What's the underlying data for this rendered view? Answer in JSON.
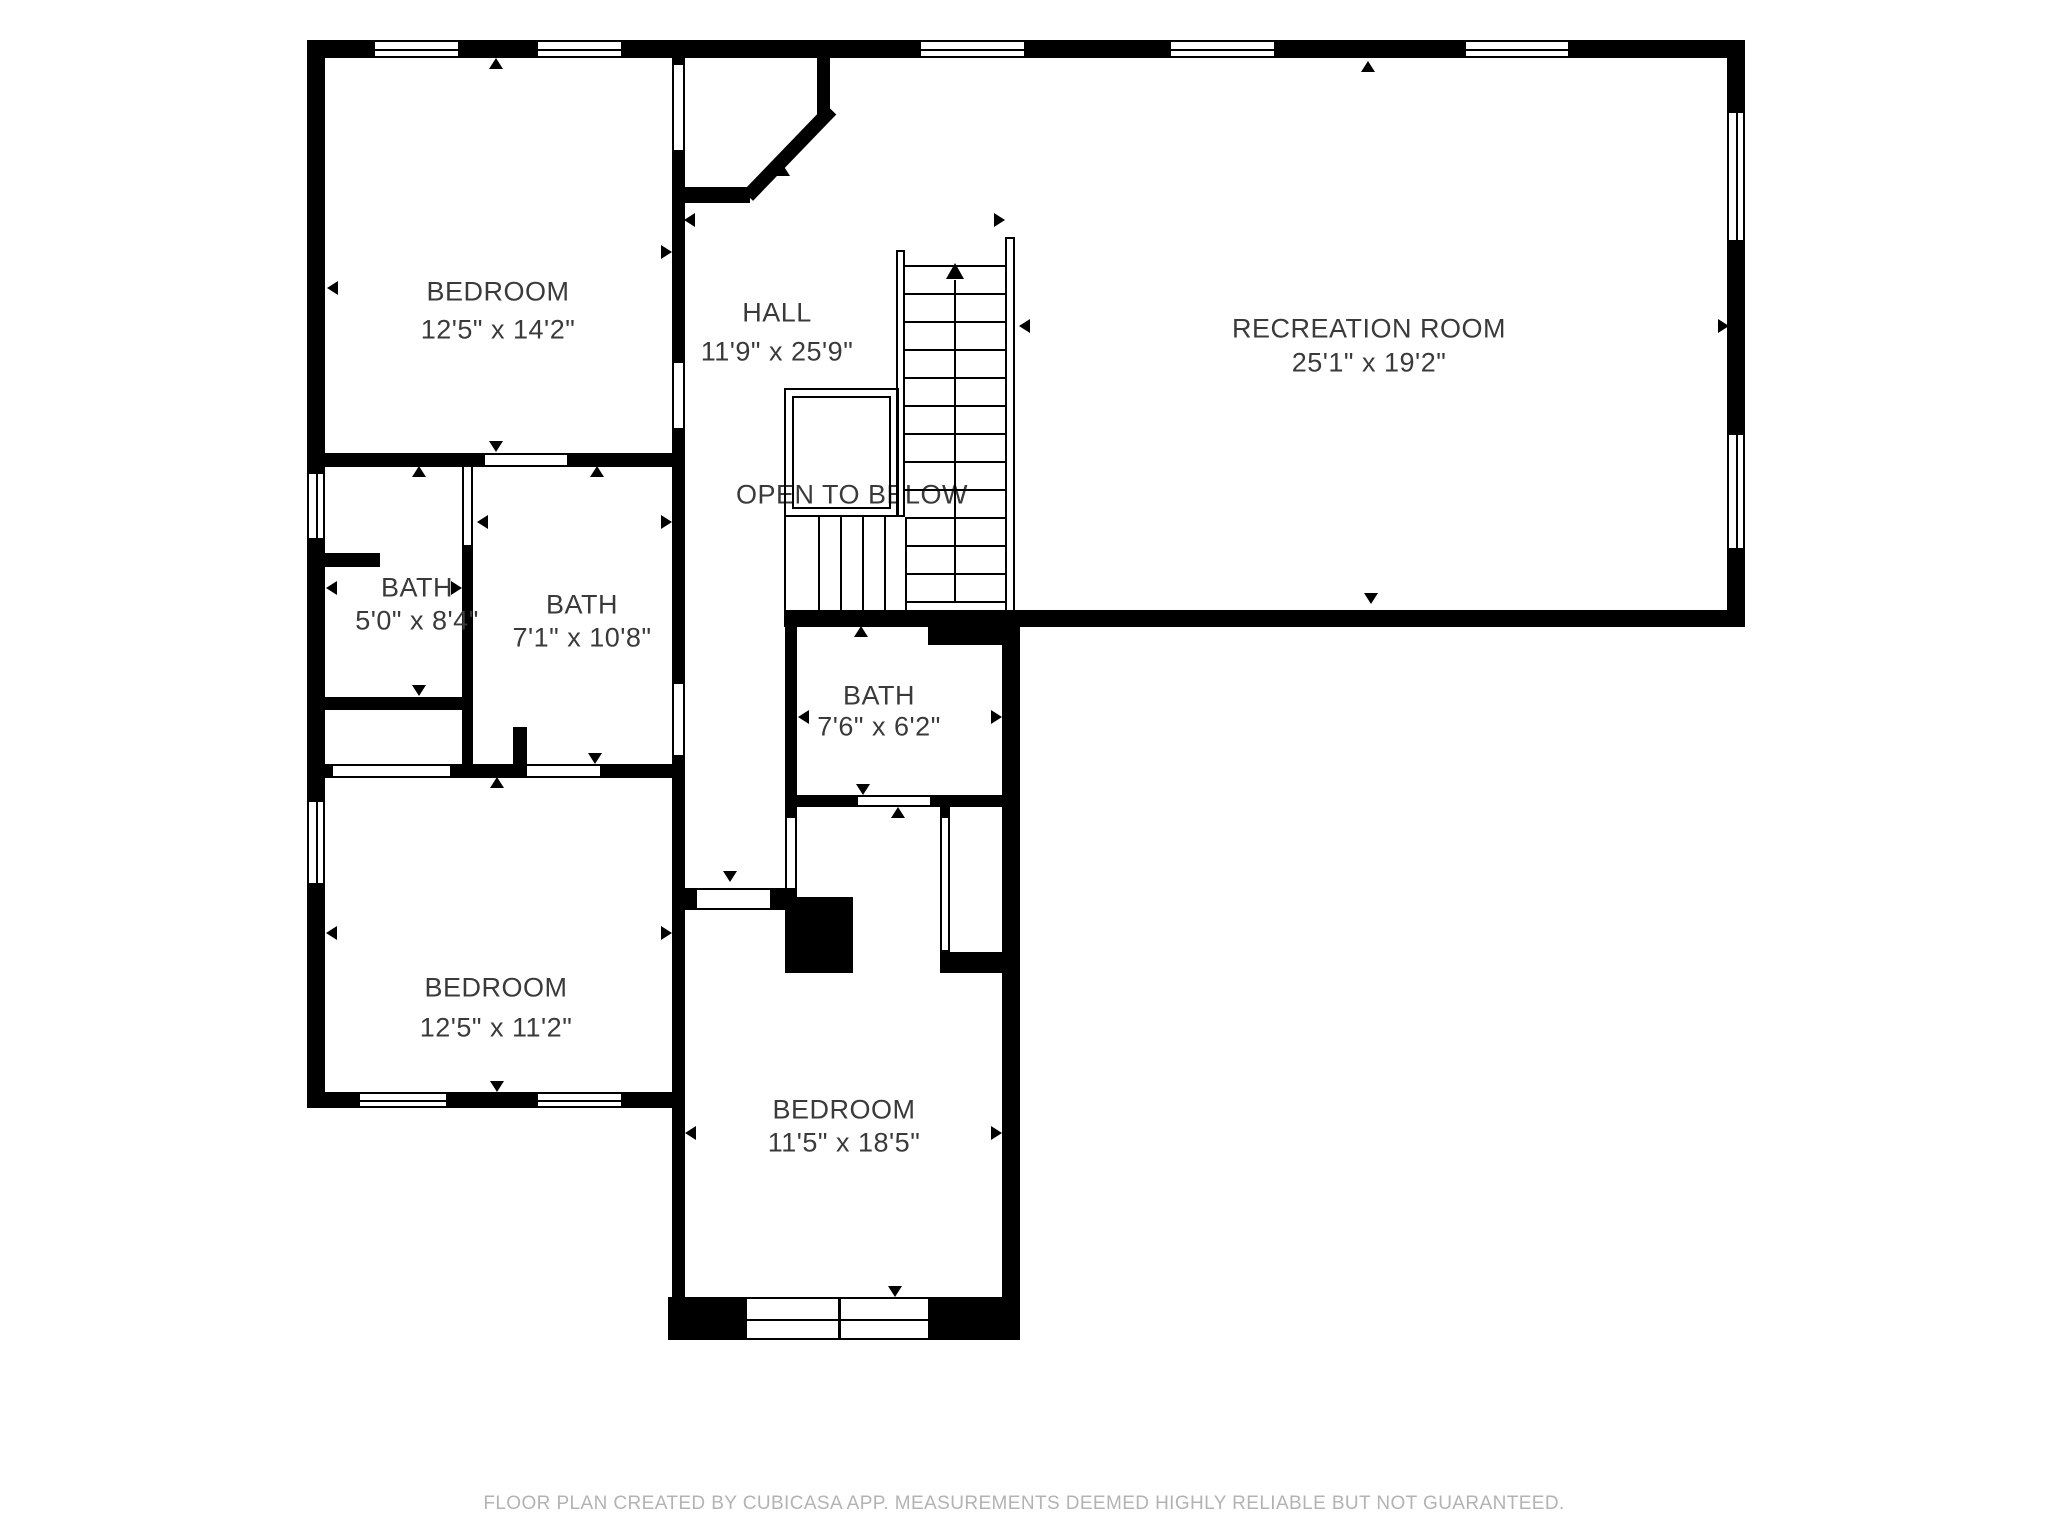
{
  "canvas": {
    "width": 2048,
    "height": 1536,
    "background": "#ffffff",
    "wall_color": "#000000",
    "label_color": "#3a3a3a",
    "footer_color": "#b3b3b3"
  },
  "rooms": [
    {
      "id": "bedroom-1",
      "label": "BEDROOM",
      "dims": "12'5\" x 14'2\"",
      "cx": 498,
      "label_y": 292,
      "dims_y": 330
    },
    {
      "id": "hall",
      "label": "HALL",
      "dims": "11'9\" x 25'9\"",
      "cx": 777,
      "label_y": 313,
      "dims_y": 352
    },
    {
      "id": "recreation-room",
      "label": "RECREATION ROOM",
      "dims": "25'1\" x 19'2\"",
      "cx": 1369,
      "label_y": 329,
      "dims_y": 363
    },
    {
      "id": "bath-1",
      "label": "BATH",
      "dims": "5'0\" x 8'4\"",
      "cx": 417,
      "label_y": 588,
      "dims_y": 621
    },
    {
      "id": "bath-2",
      "label": "BATH",
      "dims": "7'1\" x 10'8\"",
      "cx": 582,
      "label_y": 605,
      "dims_y": 638
    },
    {
      "id": "bath-3",
      "label": "BATH",
      "dims": "7'6\" x 6'2\"",
      "cx": 879,
      "label_y": 696,
      "dims_y": 727
    },
    {
      "id": "bedroom-2",
      "label": "BEDROOM",
      "dims": "12'5\" x 11'2\"",
      "cx": 496,
      "label_y": 988,
      "dims_y": 1028
    },
    {
      "id": "bedroom-3",
      "label": "BEDROOM",
      "dims": "11'5\" x 18'5\"",
      "cx": 844,
      "label_y": 1110,
      "dims_y": 1143
    }
  ],
  "annotations": {
    "open_below": {
      "text": "OPEN TO BELOW",
      "cx": 852,
      "cy": 495
    }
  },
  "footer": {
    "text": "FLOOR PLAN CREATED BY CUBICASA APP. MEASUREMENTS DEEMED HIGHLY RELIABLE BUT NOT GUARANTEED.",
    "cx": 1024,
    "cy": 1504
  },
  "walls": [
    [
      307,
      40,
      1438,
      18
    ],
    [
      307,
      40,
      18,
      1068
    ],
    [
      672,
      58,
      13,
      1239
    ],
    [
      817,
      58,
      13,
      59
    ],
    [
      685,
      187,
      65,
      16
    ],
    [
      307,
      453,
      378,
      14
    ],
    [
      462,
      545,
      11,
      233
    ],
    [
      318,
      553,
      62,
      14
    ],
    [
      307,
      697,
      156,
      13
    ],
    [
      307,
      764,
      378,
      14
    ],
    [
      513,
      727,
      14,
      51
    ],
    [
      784,
      610,
      961,
      17
    ],
    [
      928,
      627,
      79,
      18
    ],
    [
      785,
      610,
      12,
      287
    ],
    [
      785,
      795,
      235,
      12
    ],
    [
      683,
      888,
      102,
      22
    ],
    [
      785,
      897,
      68,
      76
    ],
    [
      940,
      807,
      10,
      166
    ],
    [
      940,
      952,
      62,
      21
    ],
    [
      1002,
      610,
      18,
      687
    ],
    [
      307,
      1092,
      376,
      16
    ],
    [
      668,
      1297,
      352,
      43
    ],
    [
      1727,
      40,
      18,
      587
    ]
  ],
  "diagonal": {
    "x1": 748,
    "y1": 196,
    "x2": 827,
    "y2": 114,
    "thickness": 14
  },
  "doors": [
    {
      "x": 672,
      "y": 65,
      "w": 13,
      "h": 85,
      "o": "v"
    },
    {
      "x": 672,
      "y": 363,
      "w": 13,
      "h": 65,
      "o": "v"
    },
    {
      "x": 485,
      "y": 453,
      "w": 82,
      "h": 14,
      "o": "h"
    },
    {
      "x": 462,
      "y": 467,
      "w": 11,
      "h": 78,
      "o": "v"
    },
    {
      "x": 672,
      "y": 684,
      "w": 13,
      "h": 71,
      "o": "v"
    },
    {
      "x": 333,
      "y": 764,
      "w": 117,
      "h": 14,
      "o": "h"
    },
    {
      "x": 527,
      "y": 764,
      "w": 73,
      "h": 14,
      "o": "h"
    },
    {
      "x": 858,
      "y": 795,
      "w": 72,
      "h": 12,
      "o": "h"
    },
    {
      "x": 785,
      "y": 818,
      "w": 12,
      "h": 70,
      "o": "v"
    },
    {
      "x": 697,
      "y": 888,
      "w": 73,
      "h": 22,
      "o": "h"
    },
    {
      "x": 940,
      "y": 818,
      "w": 10,
      "h": 132,
      "o": "v"
    }
  ],
  "windows": [
    {
      "x": 373,
      "y": 40,
      "w": 87,
      "h": 18,
      "o": "h"
    },
    {
      "x": 536,
      "y": 40,
      "w": 87,
      "h": 18,
      "o": "h"
    },
    {
      "x": 919,
      "y": 40,
      "w": 107,
      "h": 18,
      "o": "h"
    },
    {
      "x": 1169,
      "y": 40,
      "w": 107,
      "h": 18,
      "o": "h"
    },
    {
      "x": 1464,
      "y": 40,
      "w": 106,
      "h": 18,
      "o": "h"
    },
    {
      "x": 307,
      "y": 472,
      "w": 18,
      "h": 68,
      "o": "v"
    },
    {
      "x": 307,
      "y": 800,
      "w": 18,
      "h": 85,
      "o": "v"
    },
    {
      "x": 1727,
      "y": 111,
      "w": 18,
      "h": 131,
      "o": "v"
    },
    {
      "x": 1727,
      "y": 433,
      "w": 18,
      "h": 117,
      "o": "v"
    },
    {
      "x": 358,
      "y": 1092,
      "w": 90,
      "h": 16,
      "o": "h"
    },
    {
      "x": 536,
      "y": 1092,
      "w": 87,
      "h": 16,
      "o": "h"
    },
    {
      "x": 745,
      "y": 1297,
      "w": 185,
      "h": 43,
      "o": "h",
      "mullion": true
    }
  ],
  "markers": [
    {
      "x": 496,
      "y": 63,
      "dir": "up"
    },
    {
      "x": 496,
      "y": 446,
      "dir": "down"
    },
    {
      "x": 332,
      "y": 288,
      "dir": "left"
    },
    {
      "x": 666,
      "y": 252,
      "dir": "right"
    },
    {
      "x": 689,
      "y": 220,
      "dir": "left"
    },
    {
      "x": 999,
      "y": 220,
      "dir": "right"
    },
    {
      "x": 783,
      "y": 170,
      "dir": "up"
    },
    {
      "x": 730,
      "y": 876,
      "dir": "down"
    },
    {
      "x": 1368,
      "y": 66,
      "dir": "up"
    },
    {
      "x": 1371,
      "y": 598,
      "dir": "down"
    },
    {
      "x": 1024,
      "y": 326,
      "dir": "left"
    },
    {
      "x": 1723,
      "y": 326,
      "dir": "right"
    },
    {
      "x": 419,
      "y": 471,
      "dir": "up"
    },
    {
      "x": 419,
      "y": 690,
      "dir": "down"
    },
    {
      "x": 331,
      "y": 588,
      "dir": "left"
    },
    {
      "x": 456,
      "y": 588,
      "dir": "right"
    },
    {
      "x": 597,
      "y": 471,
      "dir": "up"
    },
    {
      "x": 595,
      "y": 758,
      "dir": "down"
    },
    {
      "x": 482,
      "y": 522,
      "dir": "left"
    },
    {
      "x": 666,
      "y": 522,
      "dir": "right"
    },
    {
      "x": 861,
      "y": 631,
      "dir": "up"
    },
    {
      "x": 863,
      "y": 789,
      "dir": "down"
    },
    {
      "x": 803,
      "y": 717,
      "dir": "left"
    },
    {
      "x": 996,
      "y": 717,
      "dir": "right"
    },
    {
      "x": 497,
      "y": 782,
      "dir": "up"
    },
    {
      "x": 497,
      "y": 1086,
      "dir": "down"
    },
    {
      "x": 331,
      "y": 933,
      "dir": "left"
    },
    {
      "x": 666,
      "y": 933,
      "dir": "right"
    },
    {
      "x": 898,
      "y": 812,
      "dir": "up"
    },
    {
      "x": 895,
      "y": 1291,
      "dir": "down"
    },
    {
      "x": 690,
      "y": 1133,
      "dir": "left"
    },
    {
      "x": 996,
      "y": 1133,
      "dir": "right"
    }
  ],
  "stairs": {
    "rails": [
      {
        "x": 896,
        "y": 250,
        "w": 9,
        "h": 267
      },
      {
        "x": 1005,
        "y": 237,
        "w": 10,
        "h": 375
      }
    ],
    "tread_x1": 905,
    "tread_x2": 1005,
    "tread_ys": [
      265,
      293,
      321,
      349,
      377,
      405,
      433,
      461,
      489,
      517,
      545,
      573,
      601
    ],
    "center_line": {
      "x": 955,
      "y1": 280,
      "y2": 601
    },
    "up_arrow": {
      "x": 955,
      "y": 263
    },
    "winders": {
      "xs": [
        818,
        840,
        862,
        884
      ],
      "y1": 517,
      "y2": 610,
      "left": 784,
      "right": 905
    },
    "railing_boxes": [
      {
        "x": 784,
        "y": 388,
        "w": 115,
        "h": 129
      },
      {
        "x": 792,
        "y": 396,
        "w": 99,
        "h": 113
      }
    ]
  }
}
